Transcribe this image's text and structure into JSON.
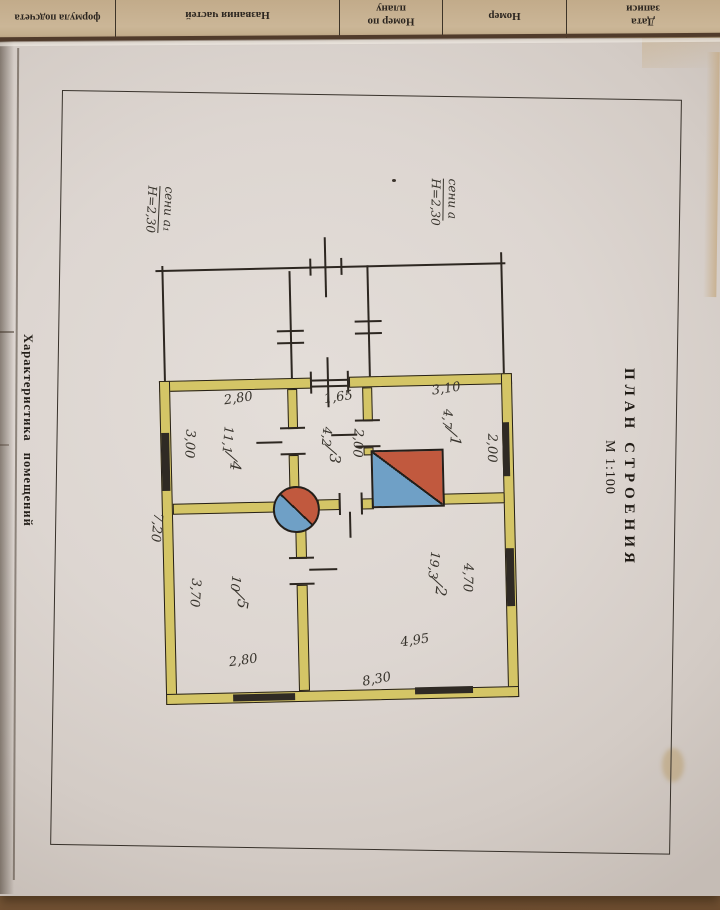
{
  "facing_page": {
    "columns": [
      {
        "label": "формула подсчета"
      },
      {
        "label": "Названия частей"
      },
      {
        "label": "Номер по плану"
      },
      {
        "label": "Номер"
      },
      {
        "label": "Дата записи"
      }
    ]
  },
  "page": {
    "side_title": "Характеристика помещений",
    "plan_title": "ПЛАН СТРОЕНИЯ",
    "plan_scale": "М 1:100"
  },
  "plan": {
    "fraction_slash": "/",
    "porch": {
      "left": {
        "name": "сени а₁",
        "height": "Н=2,30"
      },
      "right": {
        "name": "сени а",
        "height": "Н=2,30"
      }
    },
    "rooms": {
      "room1": {
        "number": "1",
        "area": "4,7"
      },
      "room2": {
        "number": "2",
        "area": "19,3"
      },
      "room3": {
        "number": "3",
        "area": "4,2"
      },
      "room4": {
        "number": "4",
        "area": "11,1"
      },
      "room5": {
        "number": "5",
        "area": "10"
      }
    },
    "dimensions": {
      "room4_top": "2,80",
      "hall_top": "1,65",
      "room1_top": "3,10",
      "room4_side": "3,00",
      "left_total": "7,20",
      "room5_side": "3,70",
      "room5_bottom": "2,80",
      "room2_bottom": "4,95",
      "bottom_total": "8,30",
      "room2_side": "4,70",
      "room1_side": "2,00",
      "hall_side": "2,00"
    }
  },
  "colors": {
    "wall_fill": "#d4c566",
    "stove_red": "#c1593e",
    "stove_blue": "#6fa0c6",
    "paper": "#ddd6d1",
    "facing_paper": "#c6b091",
    "wood": "#7d5c3c"
  }
}
